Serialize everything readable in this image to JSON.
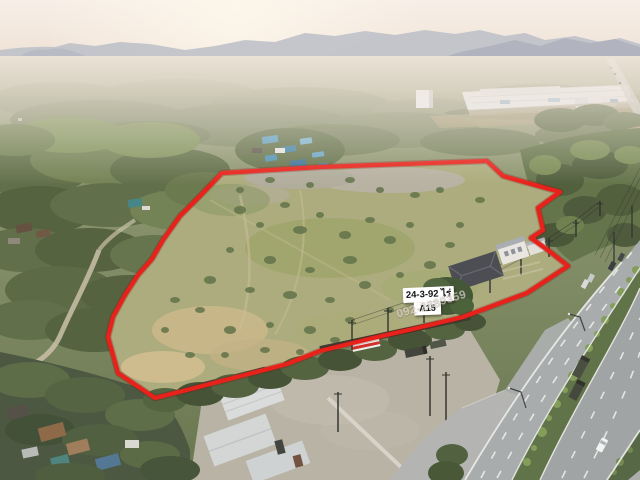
{
  "photo": {
    "area_label": "24-3-92 ไร่",
    "plot_code": "A15",
    "watermark_phone": "092-2889359"
  },
  "colors": {
    "boundary_red": "#e91812",
    "label_background": "#ffffff",
    "label_text": "#111111",
    "watermark_text": "#e4ded8"
  }
}
